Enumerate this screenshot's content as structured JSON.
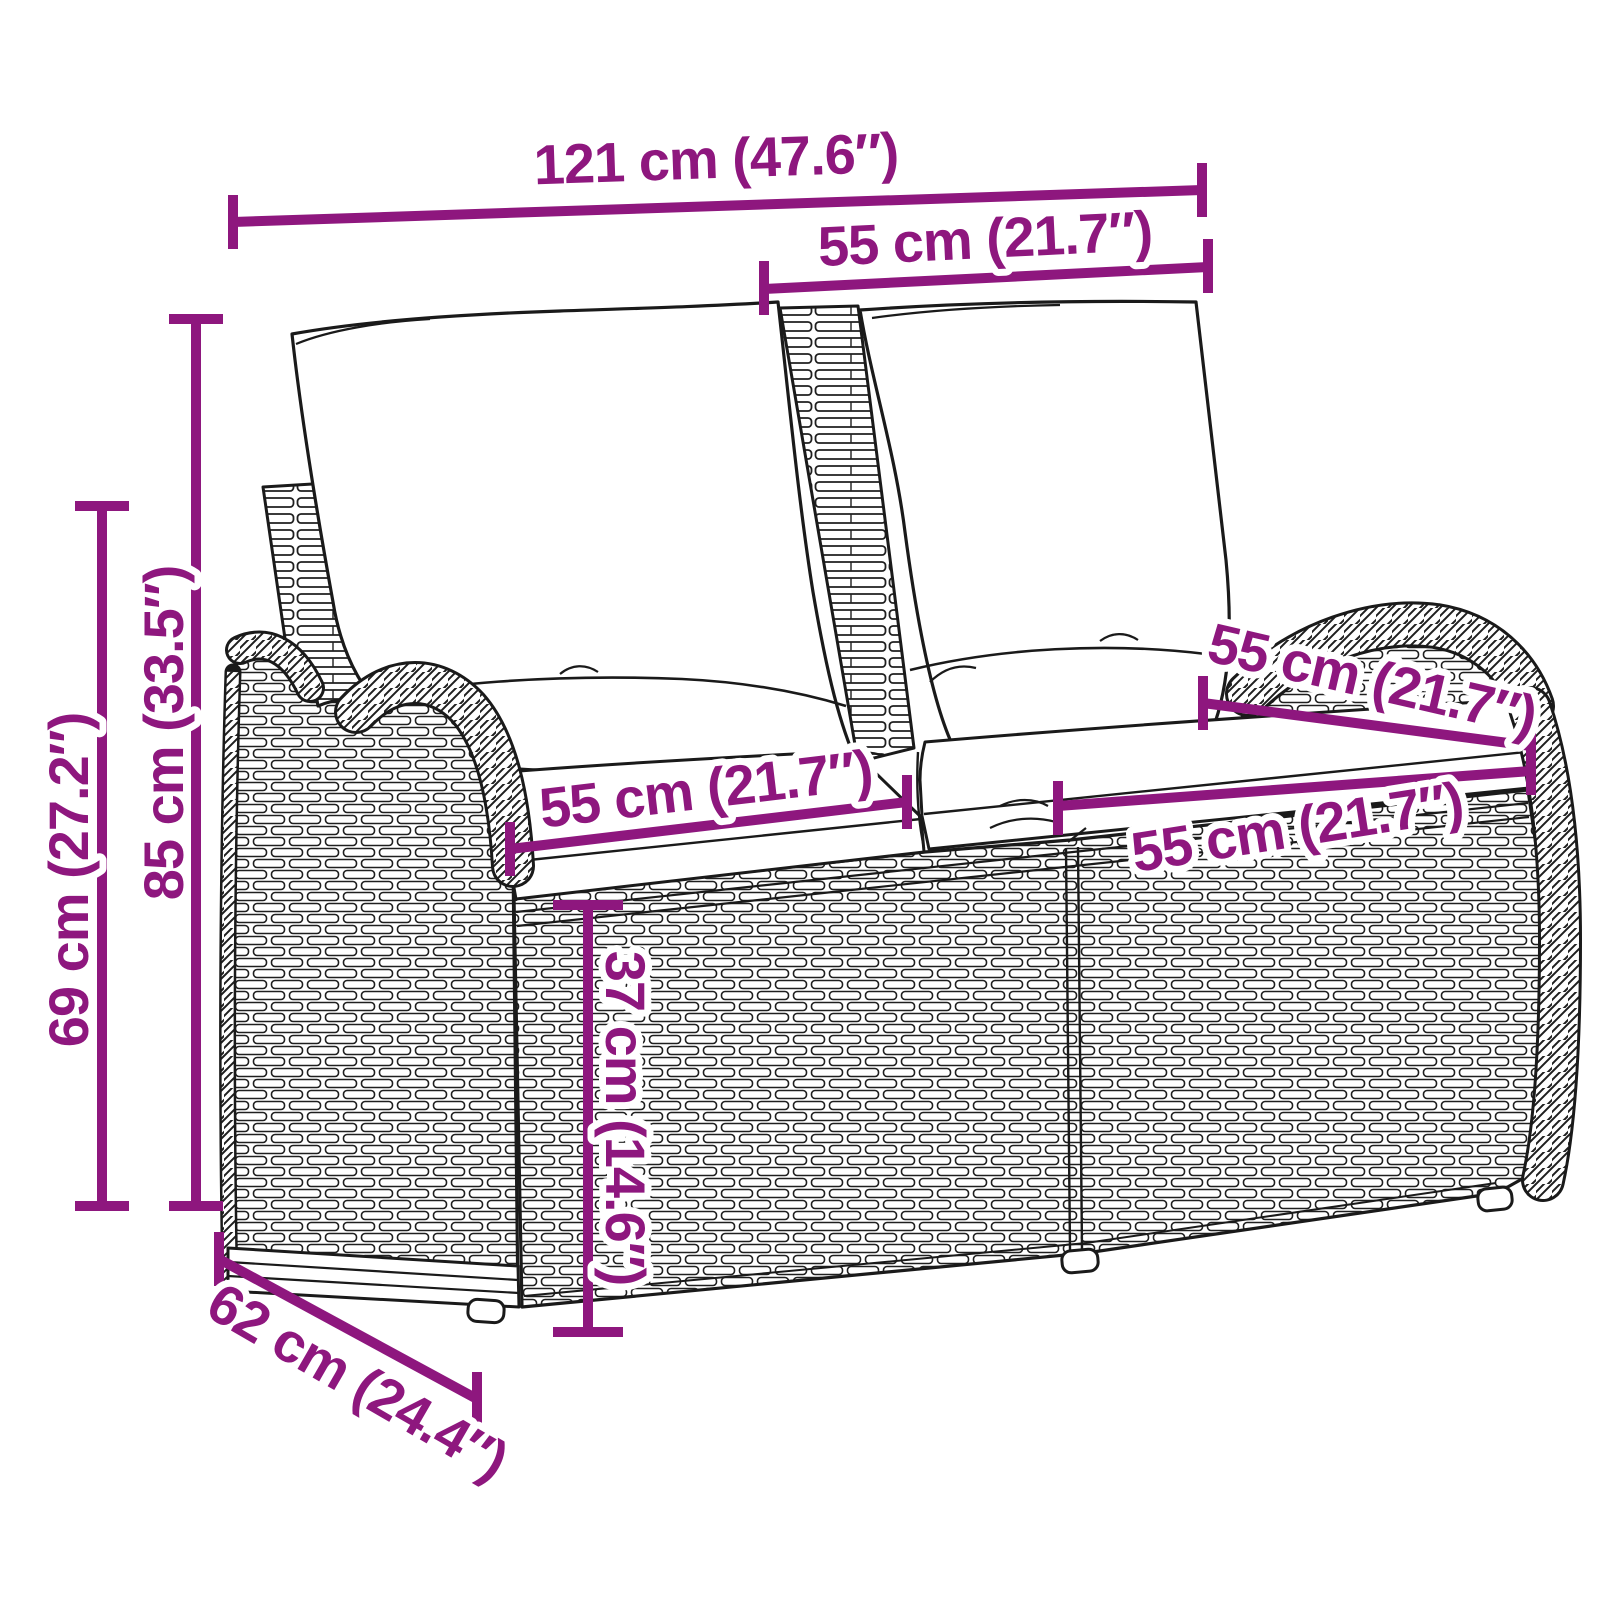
{
  "diagram": {
    "subject": "rattan-garden-bench-with-cushions",
    "accent_color": "#8E177E",
    "line_color": "#1a1a1a",
    "background_color": "#ffffff",
    "dimensions": {
      "overall_width": "121 cm (47.6″)",
      "back_cushion_width": "55 cm (21.7″)",
      "total_height": "85 cm (33.5″)",
      "armrest_height": "69 cm (27.2″)",
      "seat_width_left": "55 cm (21.7″)",
      "seat_width_right": "55 cm (21.7″)",
      "seat_depth": "55 cm (21.7″)",
      "seat_height": "37 cm (14.6″)",
      "overall_depth": "62 cm (24.4″)"
    }
  }
}
